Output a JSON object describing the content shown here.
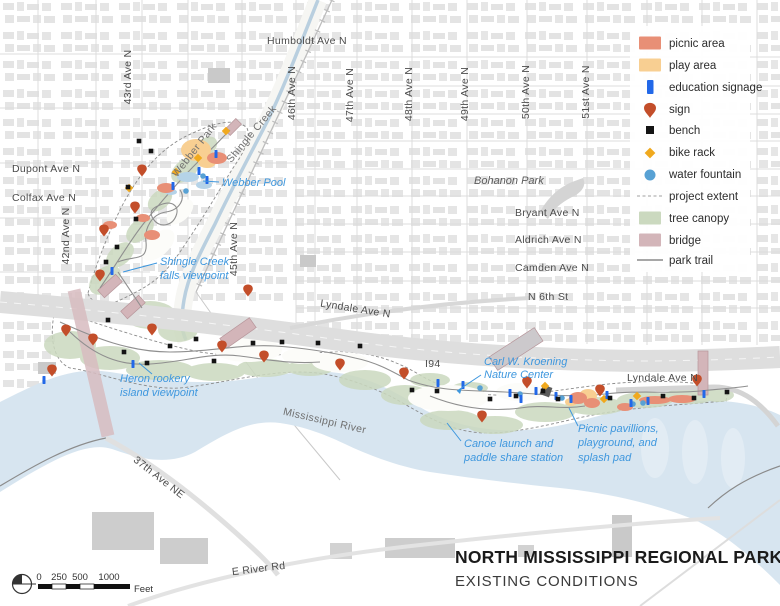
{
  "colors": {
    "picnic": "#e88f76",
    "play": "#f8cf92",
    "education": "#2268e8",
    "sign": "#c34e2a",
    "bench": "#141414",
    "bike_rack": "#f0a91e",
    "water_fountain": "#58a1d4",
    "tree_canopy": "#cbd9bf",
    "bridge": "#d3b5b9",
    "trail": "#8f8f8f",
    "river": "#d7e5f0",
    "pool": "#b5d3e8",
    "label_blue": "#3e97de"
  },
  "legend": {
    "items": [
      {
        "label": "picnic area"
      },
      {
        "label": "play area"
      },
      {
        "label": "education signage"
      },
      {
        "label": "sign"
      },
      {
        "label": "bench"
      },
      {
        "label": "bike rack"
      },
      {
        "label": "water fountain"
      },
      {
        "label": "project extent"
      },
      {
        "label": "tree canopy"
      },
      {
        "label": "bridge"
      },
      {
        "label": "park trail"
      }
    ]
  },
  "title_block": {
    "title": "NORTH MISSISSIPPI REGIONAL PARK",
    "subtitle": "EXISTING CONDITIONS"
  },
  "scale_bar": {
    "tick_labels": [
      "0",
      "250",
      "500",
      "1000"
    ],
    "unit": "Feet"
  },
  "streets": [
    {
      "label": "Humboldt Ave N"
    },
    {
      "label": "43rd Ave N"
    },
    {
      "label": "46th Ave N"
    },
    {
      "label": "47th Ave N"
    },
    {
      "label": "48th Ave N"
    },
    {
      "label": "49th Ave N"
    },
    {
      "label": "50th Ave N"
    },
    {
      "label": "51st Ave N"
    },
    {
      "label": "Dupont Ave N"
    },
    {
      "label": "Colfax Ave N"
    },
    {
      "label": "42nd Ave N"
    },
    {
      "label": "45th Ave N"
    },
    {
      "label": "Bryant Ave N"
    },
    {
      "label": "Aldrich Ave N"
    },
    {
      "label": "Camden Ave N"
    },
    {
      "label": "N 6th St"
    },
    {
      "label": "Lyndale Ave N"
    },
    {
      "label": "I94"
    },
    {
      "label": "Lyndale Ave N"
    },
    {
      "label": "37th Ave NE"
    },
    {
      "label": "E River Rd"
    }
  ],
  "places": [
    {
      "label": "Webber Park"
    },
    {
      "label": "Shingle Creek"
    },
    {
      "label": "Bohanon Park"
    },
    {
      "label": "Mississippi River"
    }
  ],
  "features": [
    {
      "lines": [
        "Webber Pool"
      ]
    },
    {
      "lines": [
        "Shingle Creek",
        "falls viewpoint"
      ]
    },
    {
      "lines": [
        "Heron rookery",
        "island viewpoint"
      ]
    },
    {
      "lines": [
        "Carl W. Kroening",
        "Nature Center"
      ]
    },
    {
      "lines": [
        "Canoe launch and",
        "paddle share station"
      ]
    },
    {
      "lines": [
        "Picnic pavillions,",
        "playground, and",
        "splash pad"
      ]
    }
  ],
  "map_markers": {
    "signs": [
      [
        142,
        171
      ],
      [
        135,
        208
      ],
      [
        104,
        231
      ],
      [
        100,
        276
      ],
      [
        66,
        331
      ],
      [
        93,
        340
      ],
      [
        52,
        371
      ],
      [
        152,
        330
      ],
      [
        222,
        347
      ],
      [
        264,
        357
      ],
      [
        248,
        291
      ],
      [
        340,
        365
      ],
      [
        404,
        374
      ],
      [
        482,
        417
      ],
      [
        527,
        383
      ],
      [
        600,
        391
      ],
      [
        697,
        381
      ]
    ],
    "benches": [
      [
        139,
        141
      ],
      [
        151,
        151
      ],
      [
        128,
        187
      ],
      [
        136,
        219
      ],
      [
        117,
        247
      ],
      [
        106,
        262
      ],
      [
        108,
        320
      ],
      [
        124,
        352
      ],
      [
        147,
        363
      ],
      [
        170,
        346
      ],
      [
        196,
        339
      ],
      [
        214,
        361
      ],
      [
        253,
        343
      ],
      [
        282,
        342
      ],
      [
        318,
        343
      ],
      [
        360,
        346
      ],
      [
        412,
        390
      ],
      [
        437,
        391
      ],
      [
        490,
        399
      ],
      [
        516,
        396
      ],
      [
        543,
        391
      ],
      [
        558,
        399
      ],
      [
        610,
        398
      ],
      [
        663,
        396
      ],
      [
        694,
        398
      ],
      [
        727,
        392
      ]
    ],
    "education_signage": [
      [
        199,
        171
      ],
      [
        207,
        180
      ],
      [
        173,
        186
      ],
      [
        216,
        154
      ],
      [
        112,
        271
      ],
      [
        44,
        380
      ],
      [
        133,
        364
      ],
      [
        438,
        383
      ],
      [
        463,
        385
      ],
      [
        510,
        393
      ],
      [
        521,
        399
      ],
      [
        536,
        391
      ],
      [
        556,
        396
      ],
      [
        571,
        399
      ],
      [
        607,
        395
      ],
      [
        631,
        403
      ],
      [
        648,
        401
      ],
      [
        704,
        394
      ]
    ],
    "bike_racks": [
      [
        198,
        158
      ],
      [
        176,
        172
      ],
      [
        226,
        131
      ],
      [
        129,
        188
      ],
      [
        545,
        386
      ],
      [
        604,
        399
      ],
      [
        637,
        396
      ]
    ],
    "water_fountains": [
      [
        203,
        176
      ],
      [
        186,
        191
      ],
      [
        562,
        398
      ],
      [
        633,
        404
      ],
      [
        643,
        403
      ],
      [
        520,
        394
      ],
      [
        480,
        388
      ]
    ],
    "picnic_areas": [
      [
        217,
        158,
        10,
        6
      ],
      [
        166,
        188,
        9,
        5
      ],
      [
        152,
        235,
        8,
        5
      ],
      [
        143,
        218,
        7,
        4
      ],
      [
        110,
        225,
        7,
        4
      ],
      [
        578,
        398,
        9,
        6
      ],
      [
        592,
        403,
        8,
        5
      ],
      [
        655,
        400,
        16,
        4
      ],
      [
        682,
        399,
        14,
        4
      ],
      [
        625,
        407,
        8,
        4
      ]
    ],
    "play_areas": [
      [
        196,
        150,
        15,
        11
      ],
      [
        207,
        162,
        9,
        6
      ],
      [
        588,
        396,
        9,
        7
      ],
      [
        571,
        402,
        6,
        4
      ]
    ],
    "pools": [
      [
        188,
        177,
        11,
        5
      ],
      [
        204,
        185,
        8,
        4
      ],
      [
        171,
        192,
        6,
        3
      ]
    ]
  }
}
